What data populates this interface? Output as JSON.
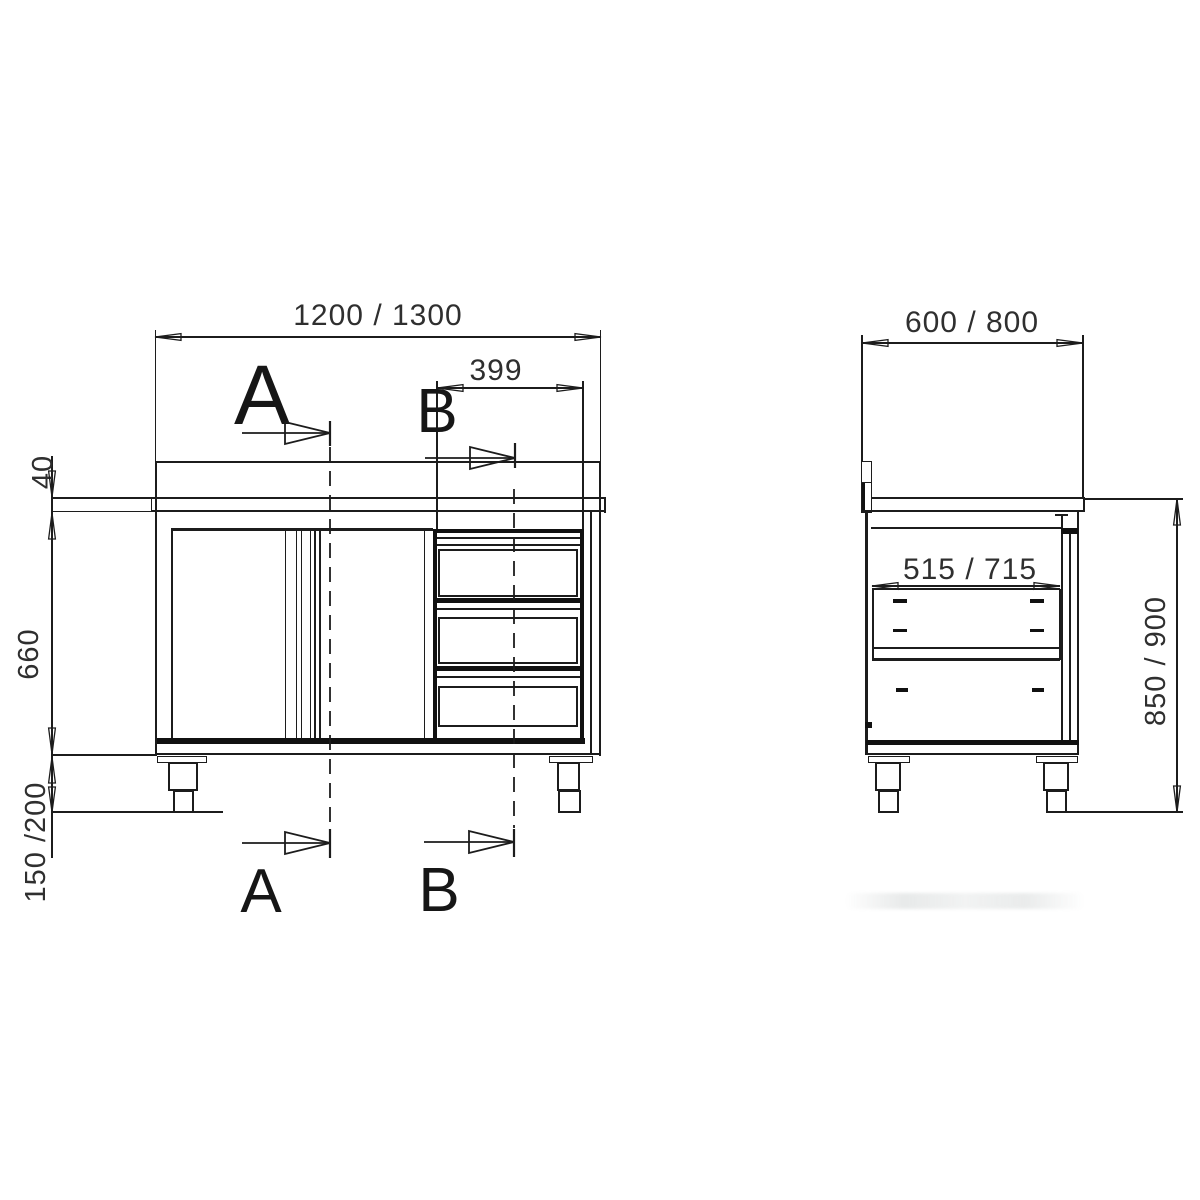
{
  "drawing": {
    "front_view": {
      "dims": {
        "overall_width": "1200 / 1300",
        "drawer_unit_width": "399",
        "worktop_thickness": "40",
        "body_height": "660",
        "feet_height": "150 /200"
      },
      "sections": {
        "a": "A",
        "b": "B"
      }
    },
    "side_view": {
      "dims": {
        "overall_depth": "600 / 800",
        "inner_depth": "515 / 715",
        "working_height": "850 / 900"
      }
    },
    "colors": {
      "line": "#1c1c1c",
      "text": "#2f2f2f",
      "background": "#ffffff"
    }
  }
}
